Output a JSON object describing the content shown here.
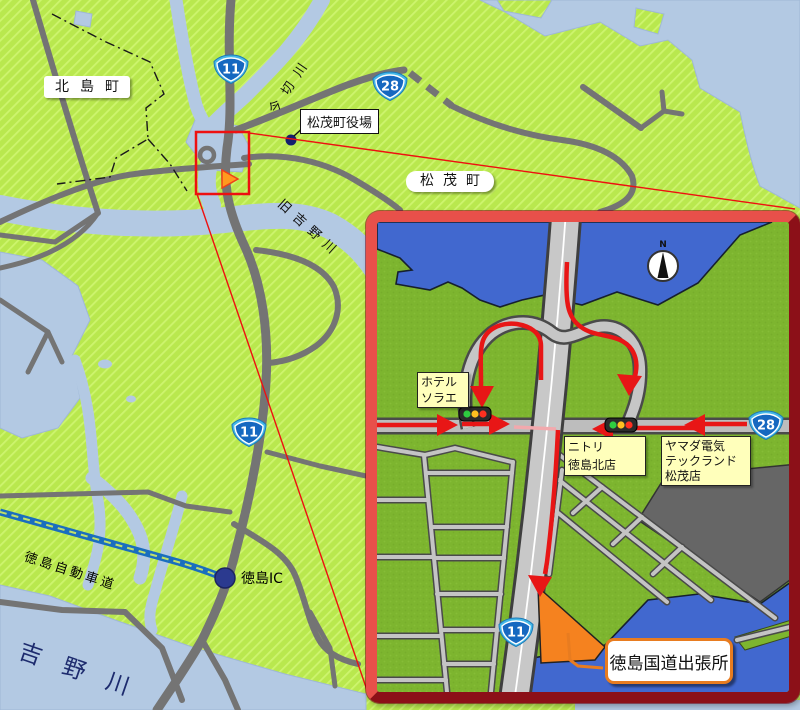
{
  "main_map": {
    "place_labels": {
      "kitajima_town": "北島町",
      "imagiri_river": "今切川",
      "matsushige_town_hall": "松茂町役場",
      "matsushige_town": "松茂町",
      "kyu_yoshino_river": "旧吉野川",
      "tokushima_expressway": "徳島自動車道",
      "tokushima_ic": "徳島IC",
      "yoshino_river": "吉野川"
    },
    "route_shields": [
      "11",
      "28",
      "11"
    ]
  },
  "inset_map": {
    "compass_label": "N",
    "route_shields": [
      "28",
      "11"
    ],
    "landmarks": {
      "hotel_sorae": [
        "ホテル",
        "ソラエ"
      ],
      "nitori": [
        "ニトリ",
        "徳島北店"
      ],
      "yamada_denki": [
        "ヤマダ電気",
        "テックランド",
        "松茂店"
      ],
      "destination": "徳島国道出張所"
    }
  },
  "colors": {
    "land_main": "#b9e84e",
    "land_hatch": "#cdf46e",
    "water_main": "#b3c9e3",
    "road_main": "#747474",
    "expressway_blue": "#1a6ebe",
    "inset_land": "#7db52f",
    "inset_water": "#4168cf",
    "inset_road": "#c6c6c6",
    "inset_road_edge": "#4a4a4a",
    "route_arrow_red": "#e81616",
    "frame_red": "#e8504a",
    "frame_dark_red": "#8c1018",
    "highlight_rect_red": "#ee1010",
    "shield_blue": "#1668c0",
    "marker_orange": "#f5821f",
    "signal_green": "#2ecc40",
    "signal_yellow": "#ffc020",
    "signal_red": "#ff3020",
    "ic_dot_navy": "#2b3a8f",
    "label_yellow": "#ffffbb",
    "callout_orange": "#e87c20"
  }
}
